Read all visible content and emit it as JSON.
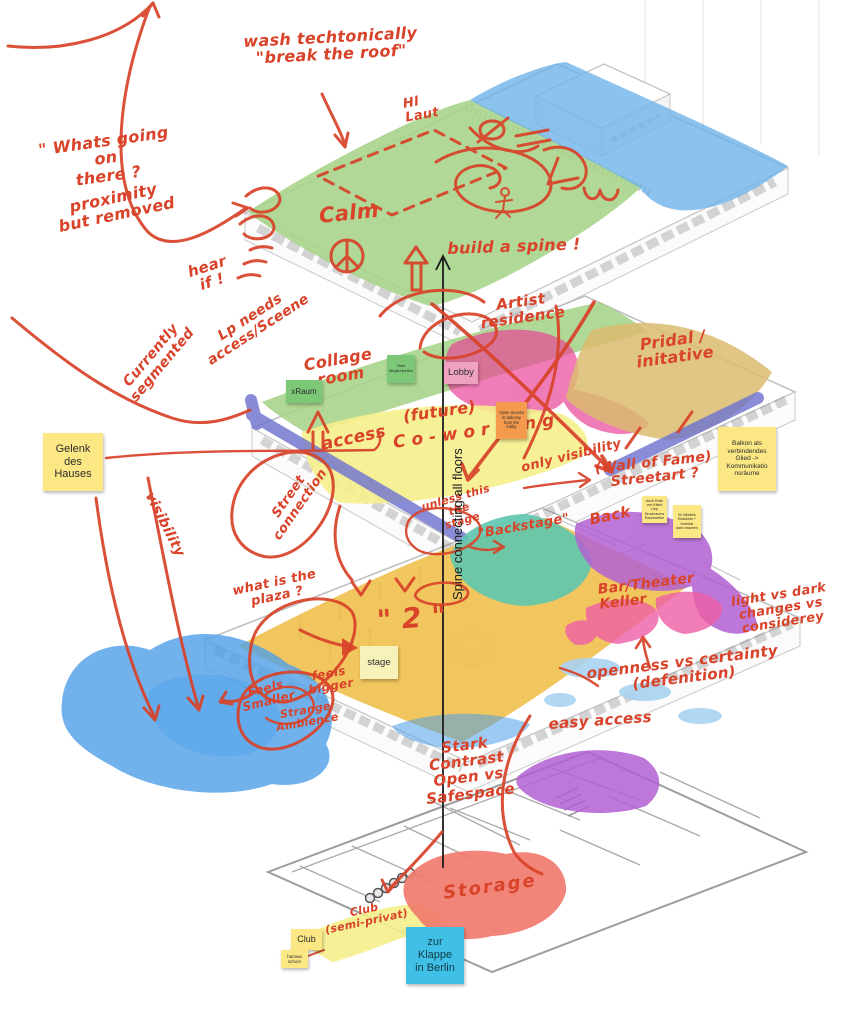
{
  "ink": {
    "red": "#d8432a",
    "black": "#1c1c1c"
  },
  "palette": {
    "green": "#a6d388",
    "blue": "#6fb3ea",
    "magenta": "#e93f96",
    "tan": "#dcbb70",
    "yellow": "#f5ee8c",
    "balcony_purple": "#6f74cf",
    "amber": "#f1c04c",
    "teal": "#5ec5ae",
    "purple": "#b160d2",
    "pink": "#ee5fa6",
    "water_blue": "#4d9fe8",
    "light_blue": "#a9d3f2",
    "salmon": "#f1786a"
  },
  "annotations": {
    "whats_going_on": "\" Whats going on\nthere ?",
    "proximity": "proximity\nbut removed",
    "hear_if": "hear\nif !",
    "wash_tech": "wash techtonically\n\"break the roof\"",
    "calm": "Calm",
    "laut": "Hl\nLaut",
    "build_spine": "build a spine !",
    "currently_segmented": "Currently\nsegmented",
    "lp_needs": "Lp needs\naccess/Sceene",
    "collage_room": "Collage\nroom",
    "artist_residence": "Artist\nresidence",
    "pridal_initiative": "Pridal /\ninitative",
    "access": "access",
    "future": "(future)",
    "co_working": "Co-working",
    "street_connection": "Street\nconnection",
    "visibility": "visibility",
    "only_visibility": "only visibility",
    "wall_of_fame": "(Wall of Fame)\nStreetart ?",
    "unless_stage": "unless this the\nstage",
    "backstage": "\"Backstage\"",
    "back": "Back",
    "bar_theater": "Bar/Theater\nKeller",
    "light_vs_dark": "light vs dark\nchanges vs considerey",
    "openness": "openness vs certainty\n(defenition)",
    "what_is_plaza": "what is the\nplaza ?",
    "big_two": "\" 2 \"",
    "feels_smaller": "Feels\nSmaller",
    "feels_bigger": "feels\nbigger",
    "strange_ambience": "Strange\nAmbience",
    "easy_access": "easy access",
    "stark_contrast": "Stark\nContrast\nOpen vs\nSafespace",
    "storage": "Storage",
    "club_semi_privat": "Club\n(semi-privat)",
    "spine": "Spine connecting all floors"
  },
  "stickies": {
    "gelenk": {
      "text": "Gelenk\ndes\nHauses",
      "bg": "#fbe783"
    },
    "balkon": {
      "text": "Balkon als\nverbindendes\nGlied ->\nKommunikatio\nnsräume",
      "bg": "#fbe783"
    },
    "xraum": {
      "text": "xRaum",
      "bg": "#7dc877"
    },
    "viele": {
      "text": "Viele\nMöglichkeiten",
      "bg": "#7dc877"
    },
    "lobby": {
      "text": "Lobby",
      "bg": "#efa2bf"
    },
    "open_access": {
      "text": "Open access\nto balcony\nfrom the\nlobby",
      "bg": "#f49a4d"
    },
    "note_klient": {
      "text": "Auch Rolle\nvon Klient\nLiep\nDruckraums\nRaumwerke",
      "bg": "#fbe783"
    },
    "note_inventar": {
      "text": "W. Middels\nErlaubnis +\nInventar\nkann machen",
      "bg": "#fbe783"
    },
    "stage": {
      "text": "stage",
      "bg": "#f7f1ba"
    },
    "club": {
      "text": "Club",
      "bg": "#fbe783"
    },
    "hamwa": {
      "text": "hamwa\nschon!",
      "bg": "#fbe783"
    },
    "zur_klappe": {
      "text": "zur\nKlappe\nin Berlin",
      "bg": "#40c0e7"
    }
  }
}
